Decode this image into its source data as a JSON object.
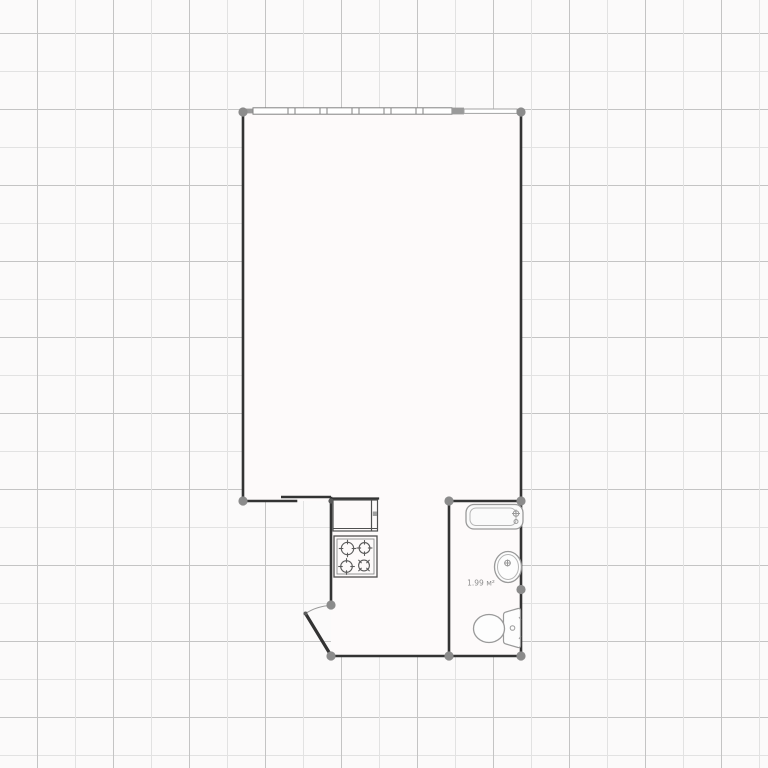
{
  "floor_plan": {
    "bathroom_area_label": "1.99 м²",
    "rooms": [
      "main-room",
      "kitchen-area",
      "bathroom"
    ],
    "fixtures": [
      "window",
      "sliding-door",
      "entry-door",
      "kitchen-counter",
      "stove",
      "bathtub",
      "sink",
      "toilet"
    ],
    "colors": {
      "wall": "#333333",
      "joint_dot": "#8b8b8b",
      "fixture_outline": "#9a9a9a",
      "floor": "#fdfafa",
      "background": "#fbfafa",
      "grid_line_dark": "#c4c4c4",
      "grid_line_light": "#e2e2e2",
      "label_text": "#8d8d8d"
    }
  }
}
